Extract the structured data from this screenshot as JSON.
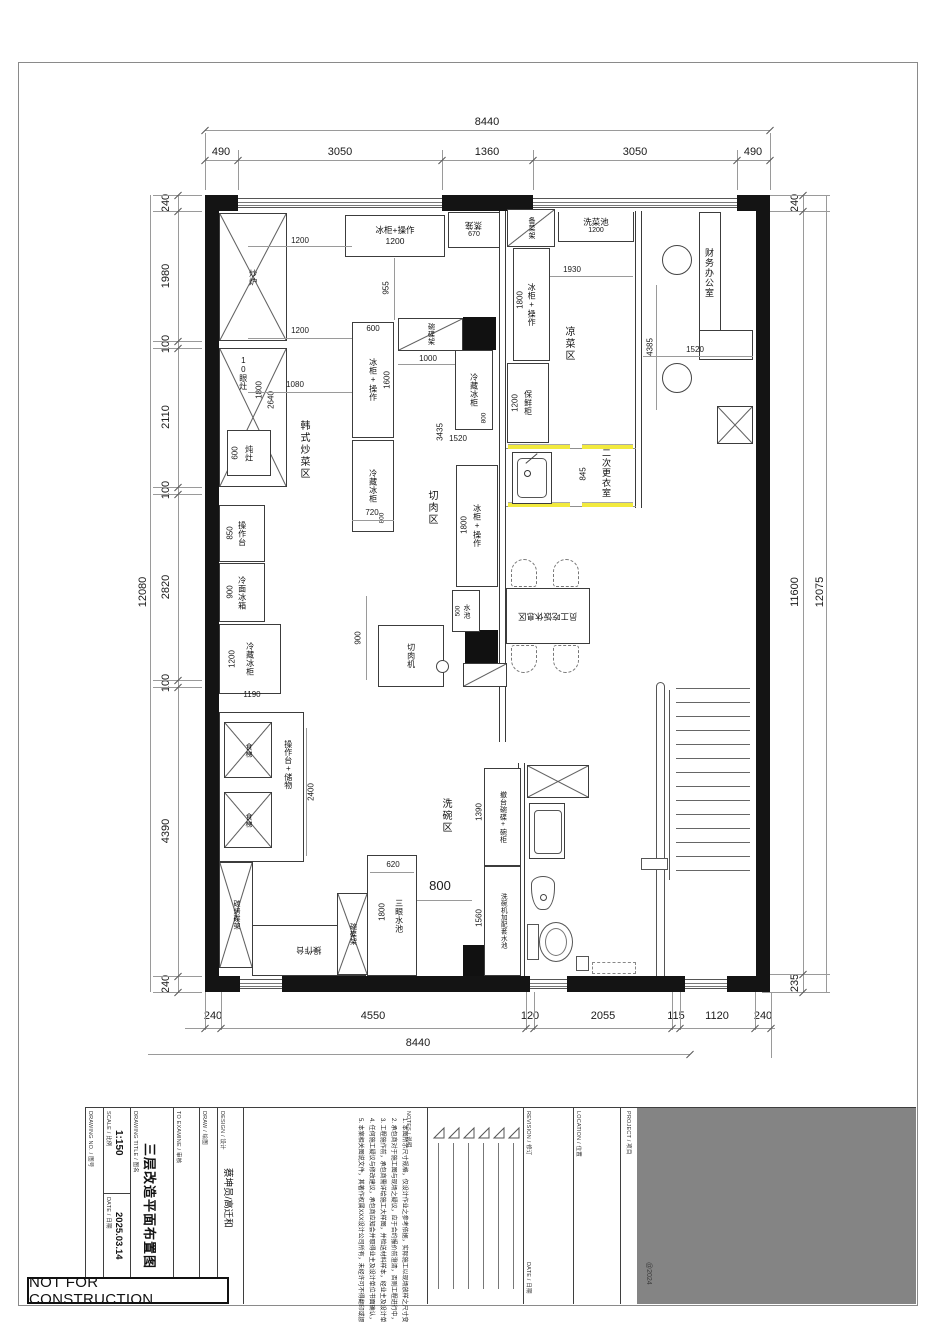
{
  "sheet": {
    "stamp": "NOT FOR CONSTRUCTION",
    "copyright": "@2024"
  },
  "colors": {
    "wall": "#141414",
    "door_highlight": "#f2ea3e",
    "project_block_gray": "#848484",
    "dim_line": "#9a9a9a"
  },
  "title_block": {
    "drawing_no_label": "DRAWING NO. / 图号",
    "scale_label": "SCALE / 比例",
    "scale": "1:150",
    "date_label": "DATE / 日期",
    "date": "2025.03.14",
    "title_label": "DRAWING TITLE / 图名",
    "title": "三层改造平面布置图",
    "examine_label": "TO EXAMINE / 审核",
    "draw_label": "DRAW / 绘图",
    "design_label": "DESIGN / 设计",
    "designers": "蔡坤员/高迁和",
    "notes_label": "NOTES / 说明",
    "notes": [
      "1. 本图所示尺寸规格，仅设计作业之参考依据，实际施工以现场放样之尺寸变化为准。",
      "2. 承包商对于施工图与现场之疑议，应于合约报价前澄清，否则工程进行中，一切依设计单位解释为准，不得私自变更。",
      "3. 工程施作前，承包商需详绘施工大样图，并检送材料样本，经业主及设计单位确认后方可施工。",
      "4. 任何施工疑议与修改建议，承包商应知会并取得业主及设计单位书面确认，作为修改之依据。",
      "5. 本案相关图说文件，其著作权属XXX设计公司所有，未经许可不得翻印或挪为其他使用。"
    ],
    "revision_label": "REVISION / 修订",
    "revision_date_label": "DATE / 日期",
    "location_label": "LOCATION / 位置",
    "project_label": "PROJECT / 项目"
  },
  "labels": {
    "chaolu": "炒炉",
    "shiyanzao": "10眼灶",
    "dunzao": "炖灶",
    "caozuotai": "操作台",
    "lengmianbingxiang": "冷面冰箱",
    "lengcangbinggui": "冷藏冰柜",
    "shiti": "食梯",
    "caozuotai_chuwu": "操作台+储物",
    "tankaodiejia": "碳烤碟架",
    "binggui_caozuo": "冰柜+操作",
    "zhenglong": "蒸笼",
    "wandiejia": "碗碟架",
    "beicaijia": "备菜架",
    "xicaichi": "洗菜池",
    "baoxiangui": "保鲜柜",
    "qierouji": "切肉机",
    "shuichi": "水池",
    "chetai": "撤台碗碟+碗柜",
    "xiwanji": "洗碗机加配套水池",
    "sanyan": "三眼水池",
    "yuangong": "员工吃饭休息区",
    "hanshi": "韩式炒菜区",
    "qierouqu": "切肉区",
    "liangcai": "凉菜区",
    "ercigengyi": "二次更衣室",
    "caiwu": "财务办公室",
    "xiwanqu": "洗碗区"
  },
  "num": {
    "100": "100",
    "115": "115",
    "120": "120",
    "235": "235",
    "240": "240",
    "490": "490",
    "500": "500",
    "600": "600",
    "620": "620",
    "670": "670",
    "720": "720",
    "800": "800",
    "845": "845",
    "850": "850",
    "900": "900",
    "955": "955",
    "1000": "1000",
    "1080": "1080",
    "1120": "1120",
    "1190": "1190",
    "1200": "1200",
    "1360": "1360",
    "1390": "1390",
    "1520": "1520",
    "1560": "1560",
    "1600": "1600",
    "1800": "1800",
    "1930": "1930",
    "1980": "1980",
    "2055": "2055",
    "2110": "2110",
    "2400": "2400",
    "2640": "2640",
    "2820": "2820",
    "3050": "3050",
    "3435": "3435",
    "4385": "4385",
    "4390": "4390",
    "4550": "4550",
    "8440": "8440",
    "11600": "11600",
    "12075": "12075",
    "12080": "12080"
  }
}
